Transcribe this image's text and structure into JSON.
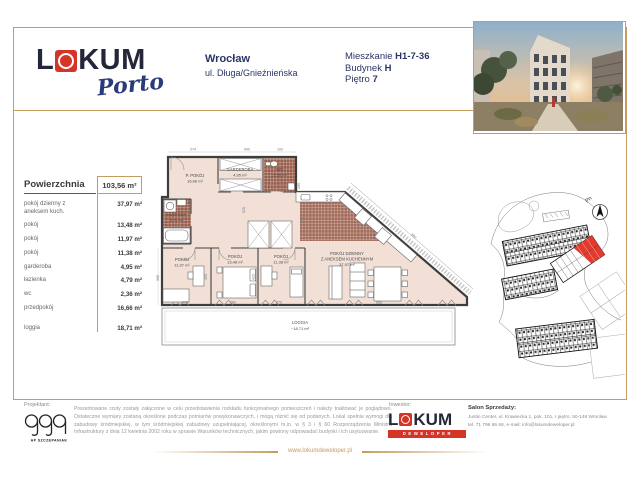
{
  "header": {
    "brand_first": "L",
    "brand_rest": "KUM",
    "brand_sub": "Porto",
    "city": "Wrocław",
    "street": "ul. Długa/Gnieźnieńska",
    "apartment_label": "Mieszkanie",
    "apartment_value": "H1-7-36",
    "building_label": "Budynek",
    "building_value": "H",
    "floor_label": "Piętro",
    "floor_value": "7"
  },
  "area_table": {
    "title": "Powierzchnia",
    "total": "103,56 m²",
    "rows": [
      {
        "label": "pokój dzienny z aneksem kuch.",
        "value": "37,97 m²"
      },
      {
        "label": "pokój",
        "value": "13,48 m²"
      },
      {
        "label": "pokój",
        "value": "11,97 m²"
      },
      {
        "label": "pokój",
        "value": "11,38 m²"
      },
      {
        "label": "garderoba",
        "value": "4,95 m²"
      },
      {
        "label": "łazienka",
        "value": "4,79 m²"
      },
      {
        "label": "wc",
        "value": "2,36 m²"
      },
      {
        "label": "przedpokój",
        "value": "16,66 m²"
      },
      {
        "label": "loggia",
        "value": "18,71 m²"
      }
    ]
  },
  "floor_plan": {
    "rooms": {
      "przedpokoj": {
        "name": "P. POKÓJ",
        "area": "16,66 m²"
      },
      "garderoba": {
        "name": "GARDEROBA",
        "area": "4,95 m²"
      },
      "wc": {
        "name": "WC",
        "area": "2,36 m²"
      },
      "lazienka": {
        "name": "ŁAZIENKA",
        "area": "4,79 m²"
      },
      "pokoj_1": {
        "name": "POKÓJ",
        "area": "11,97 m²"
      },
      "pokoj_2": {
        "name": "POKÓJ",
        "area": "13,48 m²"
      },
      "pokoj_3": {
        "name": "POKÓJ",
        "area": "11,38 m²"
      },
      "salon": {
        "name_line1": "POKÓJ DZIENNY",
        "name_line2": "Z ANEKSEM KUCHENNYM",
        "area": "37,97 m²"
      },
      "loggia": {
        "name": "LOGGIA",
        "area": "~18,71 m²"
      }
    },
    "dimensions": {
      "top_1": "274",
      "top_2": "940",
      "top_3": "100",
      "bottom_1": "296",
      "bottom_2": "280",
      "bottom_3": "270",
      "bottom_4": "868",
      "left_1": "368",
      "mid_1": "403",
      "mid_2": "423",
      "mid_3": "525",
      "mid_4": "245",
      "mid_5": "190",
      "diag_1": "880",
      "bath_1": "180"
    }
  },
  "site_plan": {
    "north_label": "Pn"
  },
  "footer": {
    "designer_label": "Projektant:",
    "designer_name": "AP SZCZEPANIAK",
    "disclaimer": "Prezentowane rzuty zostały załączone w celu przedstawienia rozkładu funkcjonalnego pomieszczeń i należy traktować je poglądowo. Ostateczne wymiary zostaną określone podczas pomiarów powykonawczych, i mogą różnić się od podanych. Lokal spełnia wymogi dla zabudowy śródmiejskiej, w tym śródmiejskiej zabudowy uzupełniającej, określonymi m.in. w § 3 i § 60 Rozporządzenia Ministra Infrastruktury z dnia 12 kwietnia 2002 roku w sprawie Warunków technicznych, jakim powinny odpowiadać budynki i ich usytuowanie.",
    "investor_label": "Inwestor:",
    "investor_brand_first": "L",
    "investor_brand_rest": "KUM",
    "investor_brand_sub": "DEWELOPER",
    "sales_title": "Salon Sprzedaży:",
    "sales_address": "Justin Center, ul. Krawiecka 1, pok. 101, I piętro, 50-148 Wrocław",
    "sales_contact": "tel. 71 796 66 66, e-mail: info@lokumdeweloper.pl",
    "website": "www.lokumdeweloper.pl"
  },
  "colors": {
    "gold": "#C49B60",
    "navy": "#2A3567",
    "brand_red": "#D63426",
    "room_fill": "#F2E0D7",
    "tile_brown": "#9A5F4C",
    "highlight_red": "#E23B2E"
  }
}
